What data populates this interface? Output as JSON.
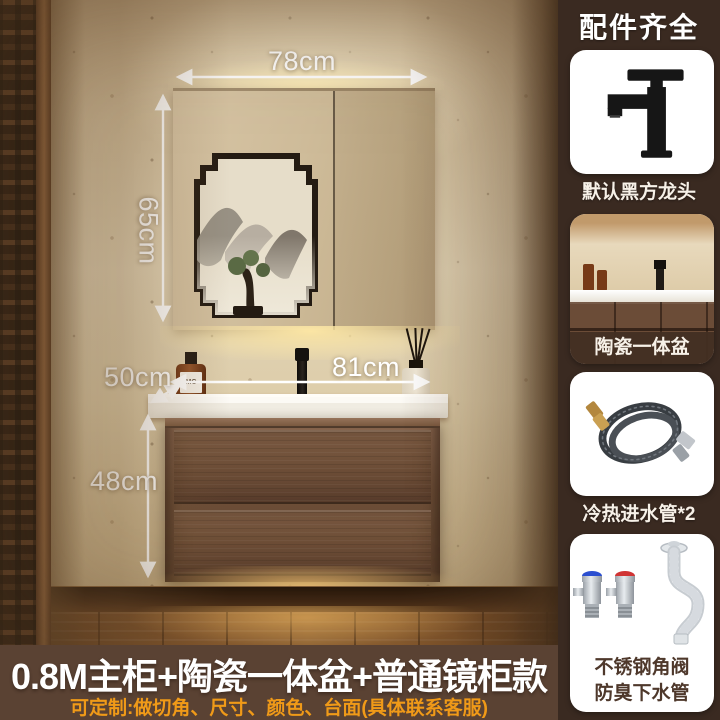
{
  "sidebar": {
    "header": "配件齐全",
    "cards": [
      {
        "caption": "默认黑方龙头",
        "icon": "black-faucet-icon"
      },
      {
        "caption": "陶瓷一体盆",
        "icon": "ceramic-basin-photo"
      },
      {
        "caption": "冷热进水管*2",
        "icon": "hot-cold-hose-icon"
      },
      {
        "caption_line1": "不锈钢角阀",
        "caption_line2": "防臭下水管",
        "icon": "angle-valve-drain-icon"
      }
    ]
  },
  "scene": {
    "dimensions": {
      "mirror_width": "78cm",
      "mirror_height": "65cm",
      "counter_depth": "50cm",
      "counter_width": "81cm",
      "cabinet_height": "48cm"
    },
    "soap_bottle_label": "MC"
  },
  "footer": {
    "title": "0.8M主柜+陶瓷一体盆+普通镜柜款",
    "subtitle": "可定制:做切角、尺寸、颜色、台面(具体联系客服)"
  },
  "colors": {
    "sidebar_bg": "#3a2a21",
    "footer_bg": "#5a4233",
    "accent_orange": "#f09a18",
    "card_bg": "#ffffff",
    "dimension_text": "#ffffff",
    "caption_dark": "#4e382b"
  }
}
